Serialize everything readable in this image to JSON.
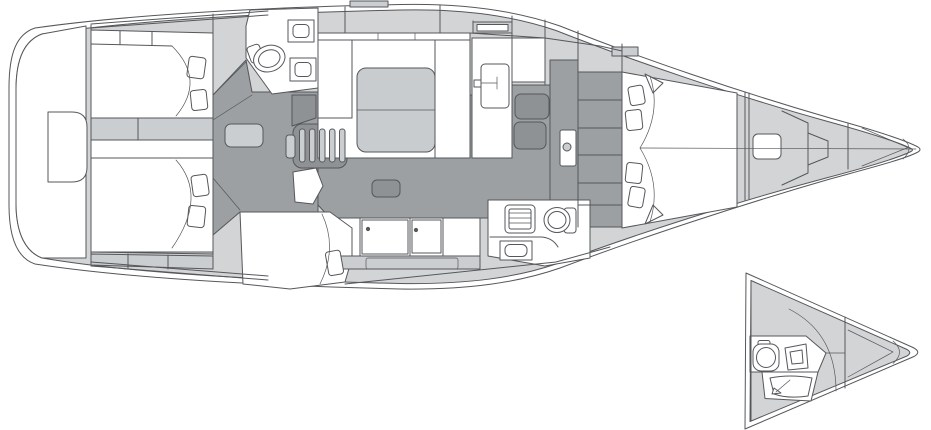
{
  "palette": {
    "background": "#ffffff",
    "line": "#55575a",
    "line_soft": "#8a8d90",
    "white": "#ffffff",
    "deck": "#d2d4d6",
    "furniture": "#cbced1",
    "floor": "#9ca0a3",
    "floor_dark": "#8e9295",
    "table": "#c9ccce"
  },
  "diagram": {
    "type": "sailing-yacht-interior-deck-plan",
    "views": [
      {
        "id": "main",
        "name": "full-interior-plan"
      },
      {
        "id": "inset",
        "name": "bow-alternative-head-layout"
      }
    ],
    "regions": [
      {
        "id": "stern-platform"
      },
      {
        "id": "aft-cabin-port"
      },
      {
        "id": "aft-cabin-starboard"
      },
      {
        "id": "mid-cabin-starboard"
      },
      {
        "id": "day-head"
      },
      {
        "id": "saloon"
      },
      {
        "id": "companionway-steps"
      },
      {
        "id": "galley"
      },
      {
        "id": "nav-counter"
      },
      {
        "id": "aft-head"
      },
      {
        "id": "owner-cabin"
      },
      {
        "id": "sail-locker"
      },
      {
        "id": "anchor-locker"
      },
      {
        "id": "bow-inset-head"
      }
    ],
    "fixtures": [
      {
        "id": "toilet",
        "count": 3
      },
      {
        "id": "sink",
        "count": 5
      },
      {
        "id": "pillow",
        "count": 9
      },
      {
        "id": "saloon-table",
        "count": 1
      },
      {
        "id": "companionway-stairs",
        "count": 1
      },
      {
        "id": "deck-hatch",
        "count": 2
      }
    ]
  }
}
